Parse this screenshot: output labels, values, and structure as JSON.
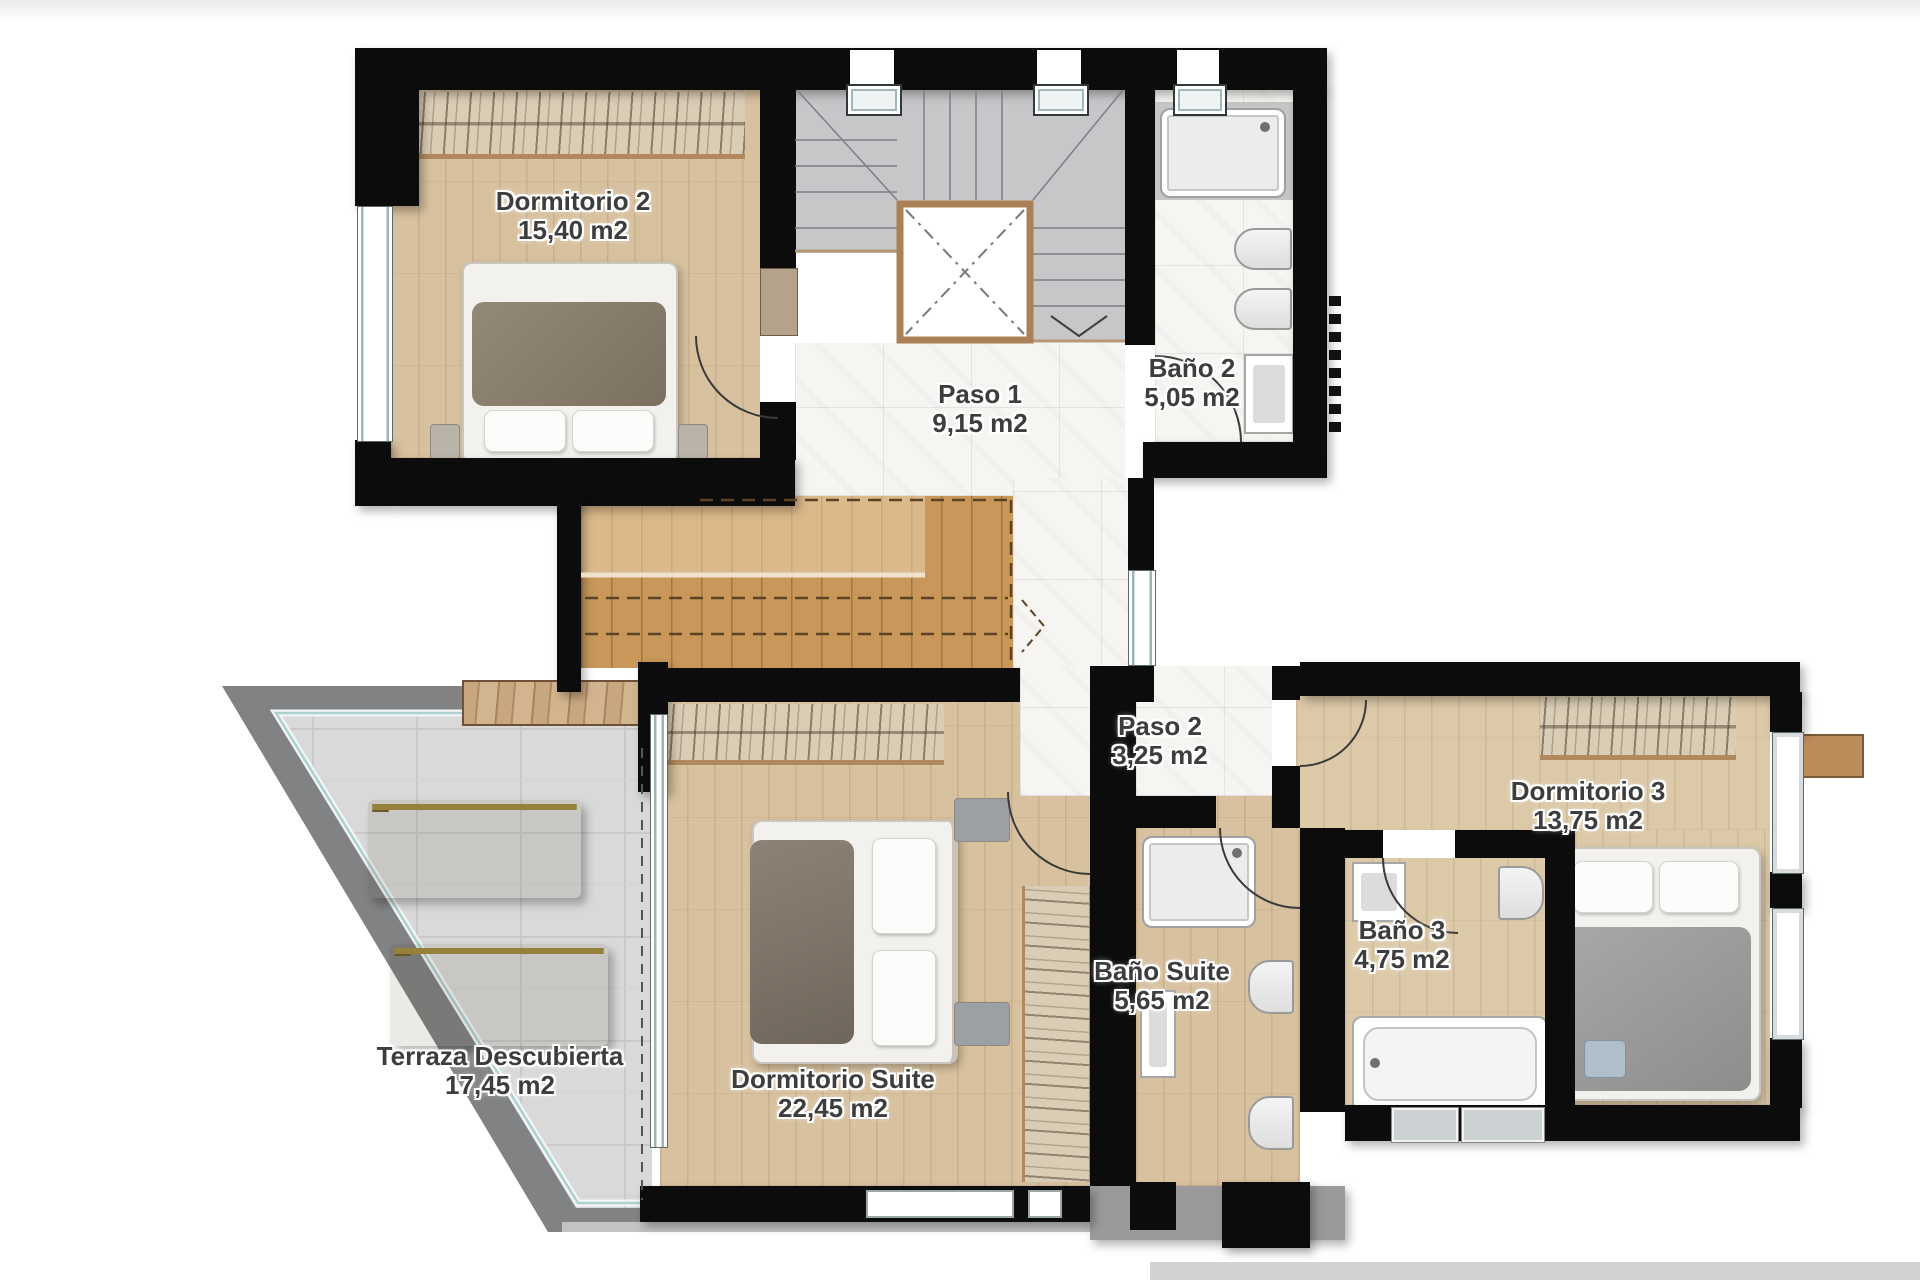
{
  "floorplan": {
    "title": "Upper floor plan",
    "rooms": [
      {
        "id": "dormitorio-2",
        "label": "Dormitorio 2",
        "area": "15,40 m2"
      },
      {
        "id": "paso-1",
        "label": "Paso 1",
        "area": "9,15 m2"
      },
      {
        "id": "bano-2",
        "label": "Baño 2",
        "area": "5,05 m2"
      },
      {
        "id": "paso-2",
        "label": "Paso 2",
        "area": "3,25 m2"
      },
      {
        "id": "dormitorio-3",
        "label": "Dormitorio 3",
        "area": "13,75 m2"
      },
      {
        "id": "bano-3",
        "label": "Baño 3",
        "area": "4,75 m2"
      },
      {
        "id": "bano-suite",
        "label": "Baño Suite",
        "area": "5,65 m2"
      },
      {
        "id": "dormitorio-suite",
        "label": "Dormitorio Suite",
        "area": "22,45 m2"
      },
      {
        "id": "terraza",
        "label": "Terraza Descubierta",
        "area": "17,45 m2"
      }
    ],
    "colors": {
      "wall_black": "#0c0c0c",
      "wood_floor": "#d7c19e",
      "marble_floor": "#f6f5f2",
      "stair_tile": "#c7c7c9",
      "terrace_tile": "#d9d9d9",
      "parapet_gray": "#808284",
      "lounger_yellow": "#e9cf6f",
      "wood_trim": "#b08a5e",
      "label_text": "#3d3d3d",
      "watermark_gray": "#d2d2d2"
    }
  }
}
